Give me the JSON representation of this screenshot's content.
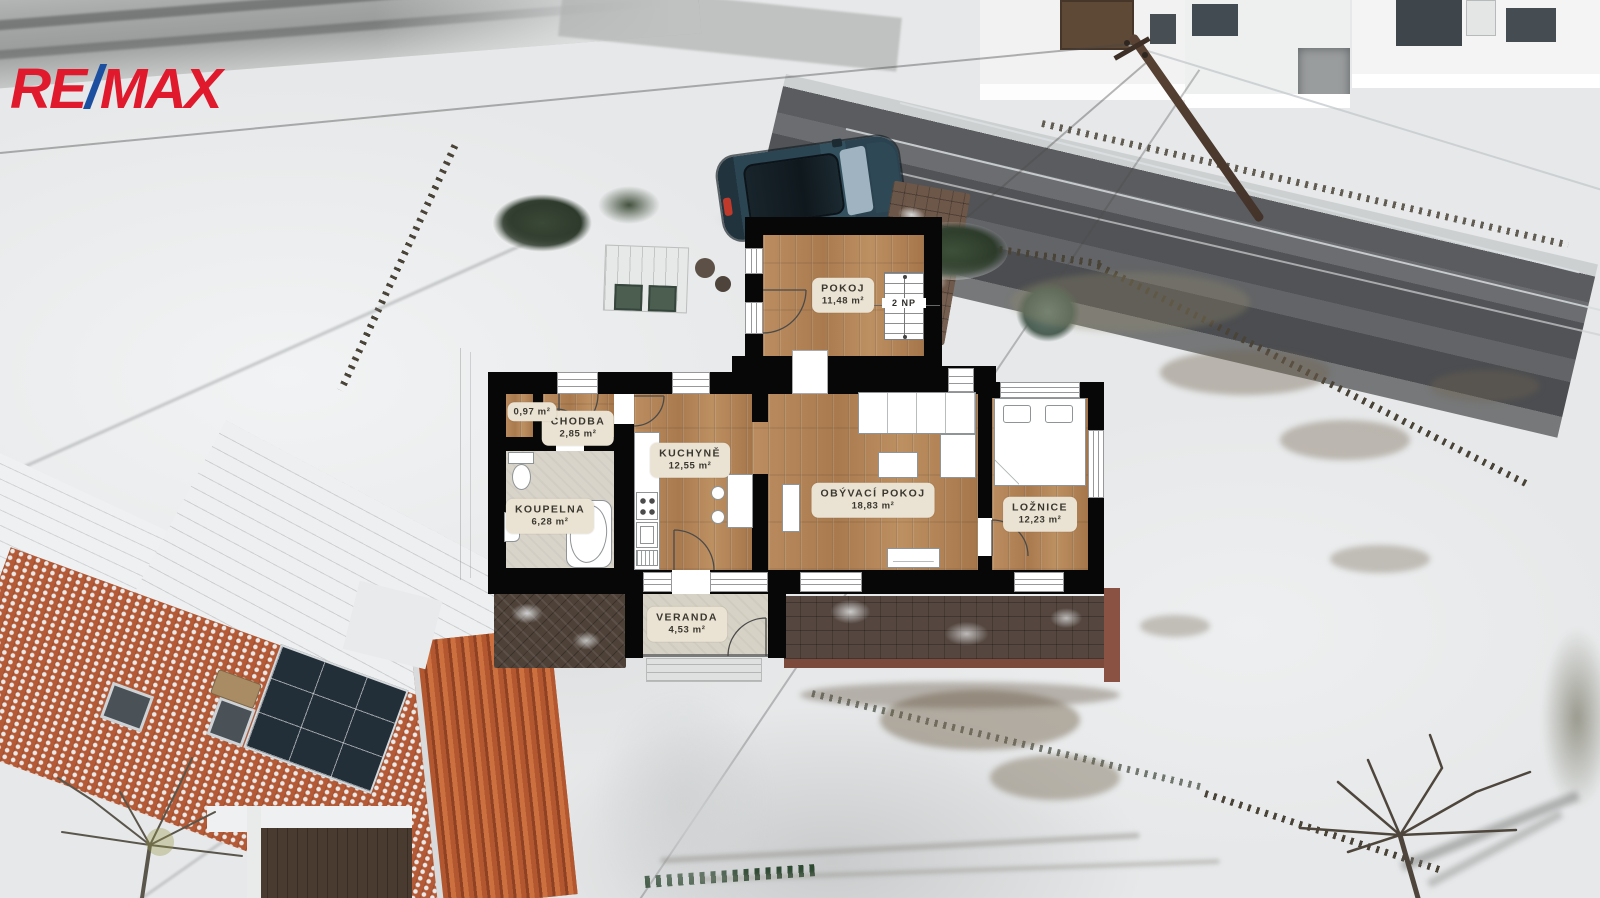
{
  "logo": {
    "re": "RE",
    "slash": "/",
    "max": "MAX"
  },
  "floor_plan": {
    "rooms": [
      {
        "name": "POKOJ",
        "area": "11,48 m²"
      },
      {
        "name": "CHODBA",
        "area": "2,85 m²"
      },
      {
        "name": "",
        "area": "0,97 m²"
      },
      {
        "name": "KOUPELNA",
        "area": "6,28 m²"
      },
      {
        "name": "KUCHYNĚ",
        "area": "12,55 m²"
      },
      {
        "name": "OBÝVACÍ POKOJ",
        "area": "18,83 m²"
      },
      {
        "name": "LOŽNICE",
        "area": "12,23 m²"
      },
      {
        "name": "VERANDA",
        "area": "4,53 m²"
      }
    ],
    "stairs_label": "2 NP"
  },
  "colors": {
    "logo_red": "#e0192d",
    "logo_blue": "#1d4fa1",
    "wall": "#070707",
    "wood": "#b4875a",
    "bath_floor": "#d8d4ca",
    "veranda_floor": "#d6d2c5",
    "label_bg": "#eae3d3",
    "label_text": "#3a372f",
    "snow": "#e6e8e9",
    "road": "#515356",
    "roof_red": "#b55a36",
    "terrace": "#554740"
  }
}
